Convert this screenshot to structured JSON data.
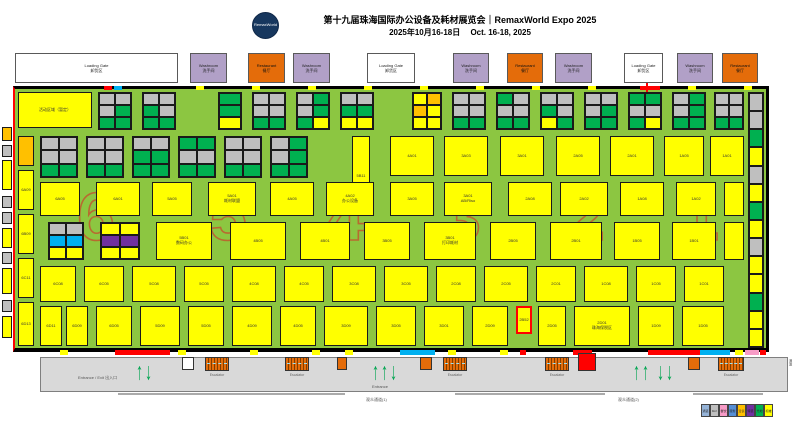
{
  "header": {
    "logo": "RemaxWorld",
    "title": "第十九届珠海国际办公设备及耗材展览会｜RemaxWorld Expo 2025",
    "subtitle": "2025年10月16-18日　 Oct. 16-18, 2025"
  },
  "palette": {
    "Y": "#FFFF00",
    "G": "#00B050",
    "N": "#BFBFBF",
    "B": "#00B0F0",
    "P": "#7030A0",
    "O": "#FFC000",
    "K": "#F79BC6",
    "W": "#FFFFFF",
    "R": "#FF0000",
    "DB": "#558ED5",
    "LB": "#95B3D7"
  },
  "facilities": [
    {
      "x": 15,
      "w": 163,
      "kind": "gate",
      "en": "Loading Gate",
      "cn": "卸货区"
    },
    {
      "x": 190,
      "w": 37,
      "kind": "wash",
      "en": "Washroom",
      "cn": "洗手间"
    },
    {
      "x": 248,
      "w": 37,
      "kind": "rest",
      "en": "Restaurant",
      "cn": "餐厅"
    },
    {
      "x": 293,
      "w": 37,
      "kind": "wash",
      "en": "Washroom",
      "cn": "洗手间"
    },
    {
      "x": 367,
      "w": 48,
      "kind": "gate",
      "en": "Loading Gate",
      "cn": "卸货区"
    },
    {
      "x": 453,
      "w": 36,
      "kind": "wash",
      "en": "Washroom",
      "cn": "洗手间"
    },
    {
      "x": 507,
      "w": 36,
      "kind": "rest",
      "en": "Restaurant",
      "cn": "餐厅"
    },
    {
      "x": 555,
      "w": 37,
      "kind": "wash",
      "en": "Washroom",
      "cn": "洗手间"
    },
    {
      "x": 624,
      "w": 39,
      "kind": "gate",
      "en": "Loading Gate",
      "cn": "卸货区"
    },
    {
      "x": 677,
      "w": 36,
      "kind": "wash",
      "en": "Washroom",
      "cn": "洗手间"
    },
    {
      "x": 722,
      "w": 36,
      "kind": "rest",
      "en": "Restaurant",
      "cn": "餐厅"
    }
  ],
  "hall": {
    "numbers": [
      "6",
      "5",
      "4",
      "3",
      "2",
      "1"
    ],
    "number_x": [
      96,
      228,
      346,
      462,
      586,
      700
    ],
    "number_color": "#C05A2E"
  },
  "clusters": [
    {
      "x": 98,
      "y": 92,
      "w": 34,
      "h": 38,
      "rows": [
        [
          "N",
          "N"
        ],
        [
          "N",
          "G"
        ],
        [
          "G",
          "G"
        ]
      ]
    },
    {
      "x": 142,
      "y": 92,
      "w": 34,
      "h": 38,
      "rows": [
        [
          "N",
          "N"
        ],
        [
          "G",
          "N"
        ],
        [
          "G",
          "G"
        ]
      ]
    },
    {
      "x": 218,
      "y": 92,
      "w": 24,
      "h": 38,
      "rows": [
        [
          "G"
        ],
        [
          "G"
        ],
        [
          "Y"
        ]
      ]
    },
    {
      "x": 252,
      "y": 92,
      "w": 34,
      "h": 38,
      "rows": [
        [
          "N",
          "N"
        ],
        [
          "N",
          "N"
        ],
        [
          "G",
          "G"
        ]
      ]
    },
    {
      "x": 296,
      "y": 92,
      "w": 34,
      "h": 38,
      "rows": [
        [
          "N",
          "G"
        ],
        [
          "N",
          "G"
        ],
        [
          "G",
          "Y"
        ]
      ]
    },
    {
      "x": 340,
      "y": 92,
      "w": 34,
      "h": 38,
      "rows": [
        [
          "N",
          "N"
        ],
        [
          "G",
          "G"
        ],
        [
          "Y",
          "Y"
        ]
      ]
    },
    {
      "x": 412,
      "y": 92,
      "w": 30,
      "h": 38,
      "rows": [
        [
          "Y",
          "O"
        ],
        [
          "O",
          "Y"
        ],
        [
          "Y",
          "Y"
        ]
      ]
    },
    {
      "x": 452,
      "y": 92,
      "w": 34,
      "h": 38,
      "rows": [
        [
          "N",
          "N"
        ],
        [
          "N",
          "N"
        ],
        [
          "G",
          "G"
        ]
      ]
    },
    {
      "x": 496,
      "y": 92,
      "w": 34,
      "h": 38,
      "rows": [
        [
          "G",
          "N"
        ],
        [
          "N",
          "N"
        ],
        [
          "G",
          "G"
        ]
      ]
    },
    {
      "x": 540,
      "y": 92,
      "w": 34,
      "h": 38,
      "rows": [
        [
          "N",
          "N"
        ],
        [
          "G",
          "N"
        ],
        [
          "Y",
          "G"
        ]
      ]
    },
    {
      "x": 584,
      "y": 92,
      "w": 34,
      "h": 38,
      "rows": [
        [
          "N",
          "N"
        ],
        [
          "N",
          "G"
        ],
        [
          "G",
          "G"
        ]
      ]
    },
    {
      "x": 628,
      "y": 92,
      "w": 34,
      "h": 38,
      "rows": [
        [
          "G",
          "G"
        ],
        [
          "N",
          "N"
        ],
        [
          "G",
          "Y"
        ]
      ]
    },
    {
      "x": 672,
      "y": 92,
      "w": 34,
      "h": 38,
      "rows": [
        [
          "N",
          "G"
        ],
        [
          "N",
          "G"
        ],
        [
          "G",
          "G"
        ]
      ]
    },
    {
      "x": 714,
      "y": 92,
      "w": 30,
      "h": 38,
      "rows": [
        [
          "N",
          "N"
        ],
        [
          "N",
          "N"
        ],
        [
          "G",
          "G"
        ]
      ]
    },
    {
      "x": 748,
      "y": 92,
      "w": 16,
      "h": 256,
      "rows": [
        [
          "N"
        ],
        [
          "N"
        ],
        [
          "G"
        ],
        [
          "Y"
        ],
        [
          "N"
        ],
        [
          "Y"
        ],
        [
          "G"
        ],
        [
          "Y"
        ],
        [
          "N"
        ],
        [
          "Y"
        ],
        [
          "Y"
        ],
        [
          "G"
        ],
        [
          "Y"
        ],
        [
          "Y"
        ]
      ]
    },
    {
      "x": 40,
      "y": 136,
      "w": 38,
      "h": 42,
      "rows": [
        [
          "N",
          "N"
        ],
        [
          "N",
          "N"
        ],
        [
          "G",
          "G"
        ]
      ]
    },
    {
      "x": 86,
      "y": 136,
      "w": 38,
      "h": 42,
      "rows": [
        [
          "N",
          "N"
        ],
        [
          "N",
          "N"
        ],
        [
          "G",
          "G"
        ]
      ]
    },
    {
      "x": 132,
      "y": 136,
      "w": 38,
      "h": 42,
      "rows": [
        [
          "N",
          "N"
        ],
        [
          "G",
          "G"
        ],
        [
          "G",
          "G"
        ]
      ]
    },
    {
      "x": 178,
      "y": 136,
      "w": 38,
      "h": 42,
      "rows": [
        [
          "G",
          "G"
        ],
        [
          "N",
          "N"
        ],
        [
          "G",
          "G"
        ]
      ]
    },
    {
      "x": 224,
      "y": 136,
      "w": 38,
      "h": 42,
      "rows": [
        [
          "N",
          "N"
        ],
        [
          "N",
          "N"
        ],
        [
          "G",
          "G"
        ]
      ]
    },
    {
      "x": 270,
      "y": 136,
      "w": 38,
      "h": 42,
      "rows": [
        [
          "N",
          "G"
        ],
        [
          "N",
          "G"
        ],
        [
          "G",
          "G"
        ]
      ]
    },
    {
      "x": 48,
      "y": 222,
      "w": 36,
      "h": 38,
      "rows": [
        [
          "N",
          "N"
        ],
        [
          "B",
          "B"
        ],
        [
          "Y",
          "Y"
        ]
      ]
    },
    {
      "x": 100,
      "y": 222,
      "w": 40,
      "h": 38,
      "rows": [
        [
          "Y",
          "Y"
        ],
        [
          "P",
          "P"
        ],
        [
          "Y",
          "Y"
        ]
      ]
    }
  ],
  "booths": [
    [
      18,
      92,
      74,
      36,
      "Y",
      "活动区域（暂定）"
    ],
    [
      18,
      136,
      16,
      30,
      "O",
      ""
    ],
    [
      18,
      170,
      16,
      40,
      "Y",
      "6A09"
    ],
    [
      18,
      214,
      16,
      40,
      "Y",
      "6B09"
    ],
    [
      18,
      258,
      16,
      40,
      "Y",
      "6C11"
    ],
    [
      18,
      302,
      16,
      44,
      "Y",
      "6D13"
    ],
    [
      352,
      136,
      18,
      80,
      "Y",
      "5B11"
    ],
    [
      390,
      136,
      44,
      40,
      "Y",
      "4A01"
    ],
    [
      444,
      136,
      44,
      40,
      "Y",
      "3A03"
    ],
    [
      500,
      136,
      44,
      40,
      "Y",
      "3A01"
    ],
    [
      556,
      136,
      44,
      40,
      "Y",
      "2A05"
    ],
    [
      610,
      136,
      44,
      40,
      "Y",
      "2A01"
    ],
    [
      664,
      136,
      40,
      40,
      "Y",
      "1A05"
    ],
    [
      710,
      136,
      34,
      40,
      "Y",
      "1A01"
    ],
    [
      40,
      182,
      40,
      34,
      "Y",
      "6A05"
    ],
    [
      96,
      182,
      44,
      34,
      "Y",
      "6A01"
    ],
    [
      152,
      182,
      40,
      34,
      "Y",
      "5A05"
    ],
    [
      208,
      182,
      48,
      34,
      "Y",
      "5A01\n耗材联盟"
    ],
    [
      270,
      182,
      44,
      34,
      "Y",
      "4A05"
    ],
    [
      326,
      182,
      48,
      34,
      "Y",
      "4A02\n办公设备"
    ],
    [
      390,
      182,
      44,
      34,
      "Y",
      "3A05"
    ],
    [
      444,
      182,
      48,
      34,
      "Y",
      "3A01\nAB/Riso"
    ],
    [
      508,
      182,
      44,
      34,
      "Y",
      "2A08"
    ],
    [
      560,
      182,
      48,
      34,
      "Y",
      "2A02"
    ],
    [
      620,
      182,
      44,
      34,
      "Y",
      "1A08"
    ],
    [
      676,
      182,
      40,
      34,
      "Y",
      "1A02"
    ],
    [
      724,
      182,
      20,
      34,
      "Y",
      ""
    ],
    [
      156,
      222,
      56,
      38,
      "Y",
      "5B01\n数码办公"
    ],
    [
      230,
      222,
      56,
      38,
      "Y",
      "4B05"
    ],
    [
      300,
      222,
      50,
      38,
      "Y",
      "4B01"
    ],
    [
      364,
      222,
      46,
      38,
      "Y",
      "3B05"
    ],
    [
      424,
      222,
      52,
      38,
      "Y",
      "3B01\n打印耗材"
    ],
    [
      490,
      222,
      46,
      38,
      "Y",
      "2B05"
    ],
    [
      550,
      222,
      52,
      38,
      "Y",
      "2B01"
    ],
    [
      614,
      222,
      46,
      38,
      "Y",
      "1B05"
    ],
    [
      672,
      222,
      44,
      38,
      "Y",
      "1B01"
    ],
    [
      724,
      222,
      20,
      38,
      "Y",
      ""
    ],
    [
      40,
      266,
      36,
      36,
      "Y",
      "6C08"
    ],
    [
      84,
      266,
      40,
      36,
      "Y",
      "6C05"
    ],
    [
      132,
      266,
      44,
      36,
      "Y",
      "5C08"
    ],
    [
      184,
      266,
      40,
      36,
      "Y",
      "5C05"
    ],
    [
      232,
      266,
      44,
      36,
      "Y",
      "4C08"
    ],
    [
      284,
      266,
      40,
      36,
      "Y",
      "4C05"
    ],
    [
      332,
      266,
      44,
      36,
      "Y",
      "3C08"
    ],
    [
      384,
      266,
      44,
      36,
      "Y",
      "3C05"
    ],
    [
      436,
      266,
      40,
      36,
      "Y",
      "2C08"
    ],
    [
      484,
      266,
      44,
      36,
      "Y",
      "2C05"
    ],
    [
      536,
      266,
      40,
      36,
      "Y",
      "2C01"
    ],
    [
      584,
      266,
      44,
      36,
      "Y",
      "1C08"
    ],
    [
      636,
      266,
      40,
      36,
      "Y",
      "1C05"
    ],
    [
      684,
      266,
      40,
      36,
      "Y",
      "1C01"
    ],
    [
      40,
      306,
      22,
      40,
      "Y",
      "6D11"
    ],
    [
      66,
      306,
      22,
      40,
      "Y",
      "6D09"
    ],
    [
      96,
      306,
      36,
      40,
      "Y",
      "6D05"
    ],
    [
      140,
      306,
      40,
      40,
      "Y",
      "5D09"
    ],
    [
      188,
      306,
      36,
      40,
      "Y",
      "5D05"
    ],
    [
      232,
      306,
      40,
      40,
      "Y",
      "4D09"
    ],
    [
      280,
      306,
      36,
      40,
      "Y",
      "4D05"
    ],
    [
      324,
      306,
      44,
      40,
      "Y",
      "3D09"
    ],
    [
      376,
      306,
      40,
      40,
      "Y",
      "3D05"
    ],
    [
      424,
      306,
      40,
      40,
      "Y",
      "3D01"
    ],
    [
      472,
      306,
      36,
      40,
      "Y",
      "2D09"
    ],
    [
      538,
      306,
      28,
      40,
      "Y",
      "2D05"
    ],
    [
      574,
      306,
      56,
      40,
      "Y",
      "2D01\n珠海保税区"
    ],
    [
      638,
      306,
      36,
      40,
      "Y",
      "1D09"
    ],
    [
      682,
      306,
      42,
      40,
      "Y",
      "1D05"
    ]
  ],
  "highlight_booth": {
    "x": 516,
    "y": 306,
    "w": 16,
    "h": 28,
    "label": "2B52"
  },
  "left_strip": [
    [
      2,
      127,
      10,
      14,
      "O"
    ],
    [
      2,
      145,
      10,
      12,
      "N"
    ],
    [
      2,
      160,
      10,
      30,
      "Y"
    ],
    [
      2,
      196,
      10,
      12,
      "N"
    ],
    [
      2,
      212,
      10,
      12,
      "N"
    ],
    [
      2,
      228,
      10,
      20,
      "Y"
    ],
    [
      2,
      252,
      10,
      12,
      "N"
    ],
    [
      2,
      268,
      10,
      26,
      "Y"
    ],
    [
      2,
      300,
      10,
      12,
      "N"
    ],
    [
      2,
      316,
      10,
      22,
      "Y"
    ]
  ],
  "walls": {
    "top": [
      [
        104,
        8,
        "R"
      ],
      [
        114,
        8,
        "B"
      ],
      [
        196,
        8,
        "Y"
      ],
      [
        252,
        8,
        "Y"
      ],
      [
        308,
        8,
        "Y"
      ],
      [
        364,
        8,
        "Y"
      ],
      [
        420,
        8,
        "Y"
      ],
      [
        476,
        8,
        "Y"
      ],
      [
        532,
        8,
        "Y"
      ],
      [
        588,
        8,
        "Y"
      ],
      [
        640,
        20,
        "R"
      ],
      [
        688,
        8,
        "Y"
      ],
      [
        744,
        8,
        "Y"
      ]
    ],
    "bottom": [
      [
        60,
        8,
        "Y"
      ],
      [
        115,
        55,
        "R"
      ],
      [
        178,
        8,
        "Y"
      ],
      [
        250,
        8,
        "Y"
      ],
      [
        312,
        8,
        "Y"
      ],
      [
        345,
        8,
        "Y"
      ],
      [
        400,
        35,
        "B"
      ],
      [
        448,
        8,
        "Y"
      ],
      [
        500,
        8,
        "Y"
      ],
      [
        520,
        6,
        "R"
      ],
      [
        573,
        19,
        "R"
      ],
      [
        648,
        52,
        "R"
      ],
      [
        700,
        30,
        "B"
      ],
      [
        735,
        8,
        "Y"
      ],
      [
        745,
        14,
        "K"
      ],
      [
        760,
        6,
        "R"
      ]
    ]
  },
  "connector_x": 646,
  "concourse": {
    "entrance_exit": "Entrance / Exit  出入口",
    "entrance": "Entrance",
    "escalator": "Escalator",
    "side_text": "通道",
    "passages": [
      "观众通道(1)",
      "观众通道(2)"
    ]
  },
  "escalators": [
    {
      "x": 205,
      "w": 24
    },
    {
      "x": 285,
      "w": 24
    },
    {
      "x": 443,
      "w": 24
    },
    {
      "x": 545,
      "w": 24
    },
    {
      "x": 718,
      "w": 26
    }
  ],
  "orange_boxes": [
    [
      337,
      10
    ],
    [
      420,
      12
    ],
    [
      688,
      12
    ]
  ],
  "white_box": [
    182,
    12
  ],
  "red_box": [
    578,
    18
  ],
  "arrow_groups": [
    {
      "x": 136,
      "dirs": [
        "u",
        "d"
      ],
      "label": false
    },
    {
      "x": 372,
      "dirs": [
        "u",
        "u",
        "d"
      ],
      "label": true
    },
    {
      "x": 633,
      "dirs": [
        "u",
        "u"
      ],
      "label": false
    },
    {
      "x": 657,
      "dirs": [
        "d",
        "d"
      ],
      "label": false
    }
  ],
  "steplines": [
    [
      118,
      227
    ],
    [
      455,
      150
    ],
    [
      693,
      70
    ]
  ],
  "legend": [
    {
      "c": "LB",
      "t": "通道"
    },
    {
      "c": "N",
      "t": "9m²"
    },
    {
      "c": "K",
      "t": "餐饮"
    },
    {
      "c": "DB",
      "t": "服务"
    },
    {
      "c": "O",
      "t": "洽谈"
    },
    {
      "c": "P",
      "t": "特装"
    },
    {
      "c": "G",
      "t": "光地"
    },
    {
      "c": "Y",
      "t": "标摊"
    }
  ]
}
